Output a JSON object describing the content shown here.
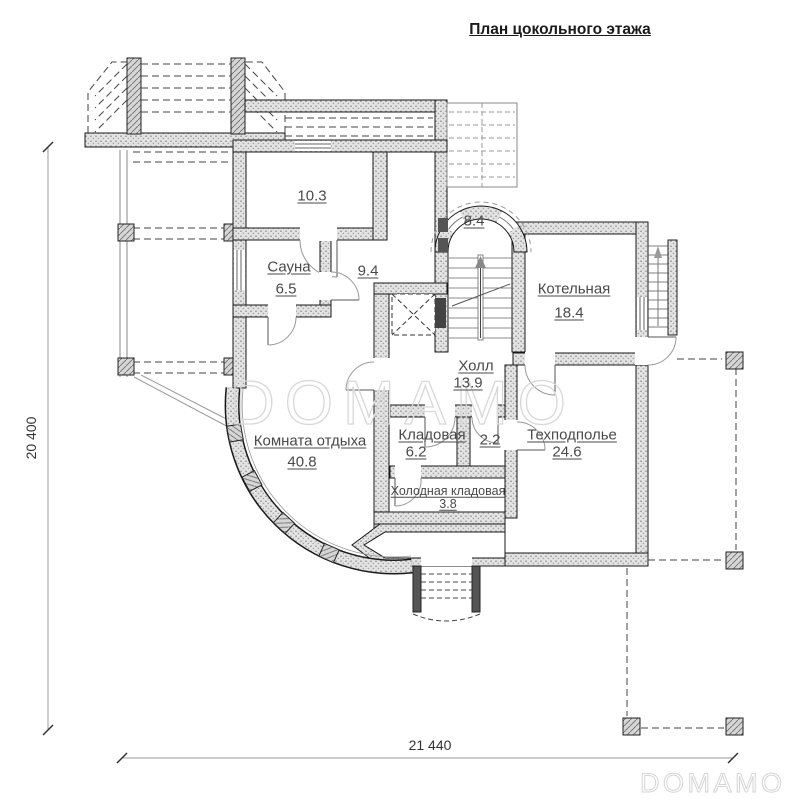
{
  "title": "План цокольного этажа",
  "watermark": {
    "text": "DOMAMO"
  },
  "dimensions": {
    "vertical": "20 400",
    "horizontal": "21 440"
  },
  "rooms": {
    "upper": {
      "area": "10.3"
    },
    "sauna": {
      "name": "Сауна",
      "area": "6.5"
    },
    "room94": {
      "area": "9.4"
    },
    "stair": {
      "area": "8.4"
    },
    "boiler": {
      "name": "Котельная",
      "area": "18.4"
    },
    "hall": {
      "name": "Холл",
      "area": "13.9"
    },
    "lounge": {
      "name": "Комната отдыха",
      "area": "40.8"
    },
    "pantry": {
      "name": "Кладовая",
      "area": "6.2"
    },
    "small": {
      "area": "2.2"
    },
    "tech": {
      "name": "Техподполье",
      "area": "24.6"
    },
    "cold": {
      "name": "Холодная кладовая",
      "area": "3.8"
    }
  },
  "colors": {
    "wall_fill": "#e3e3e3",
    "outline": "#1a1a1a",
    "label": "#4a4a4a",
    "watermark": "#d8d8d8"
  }
}
